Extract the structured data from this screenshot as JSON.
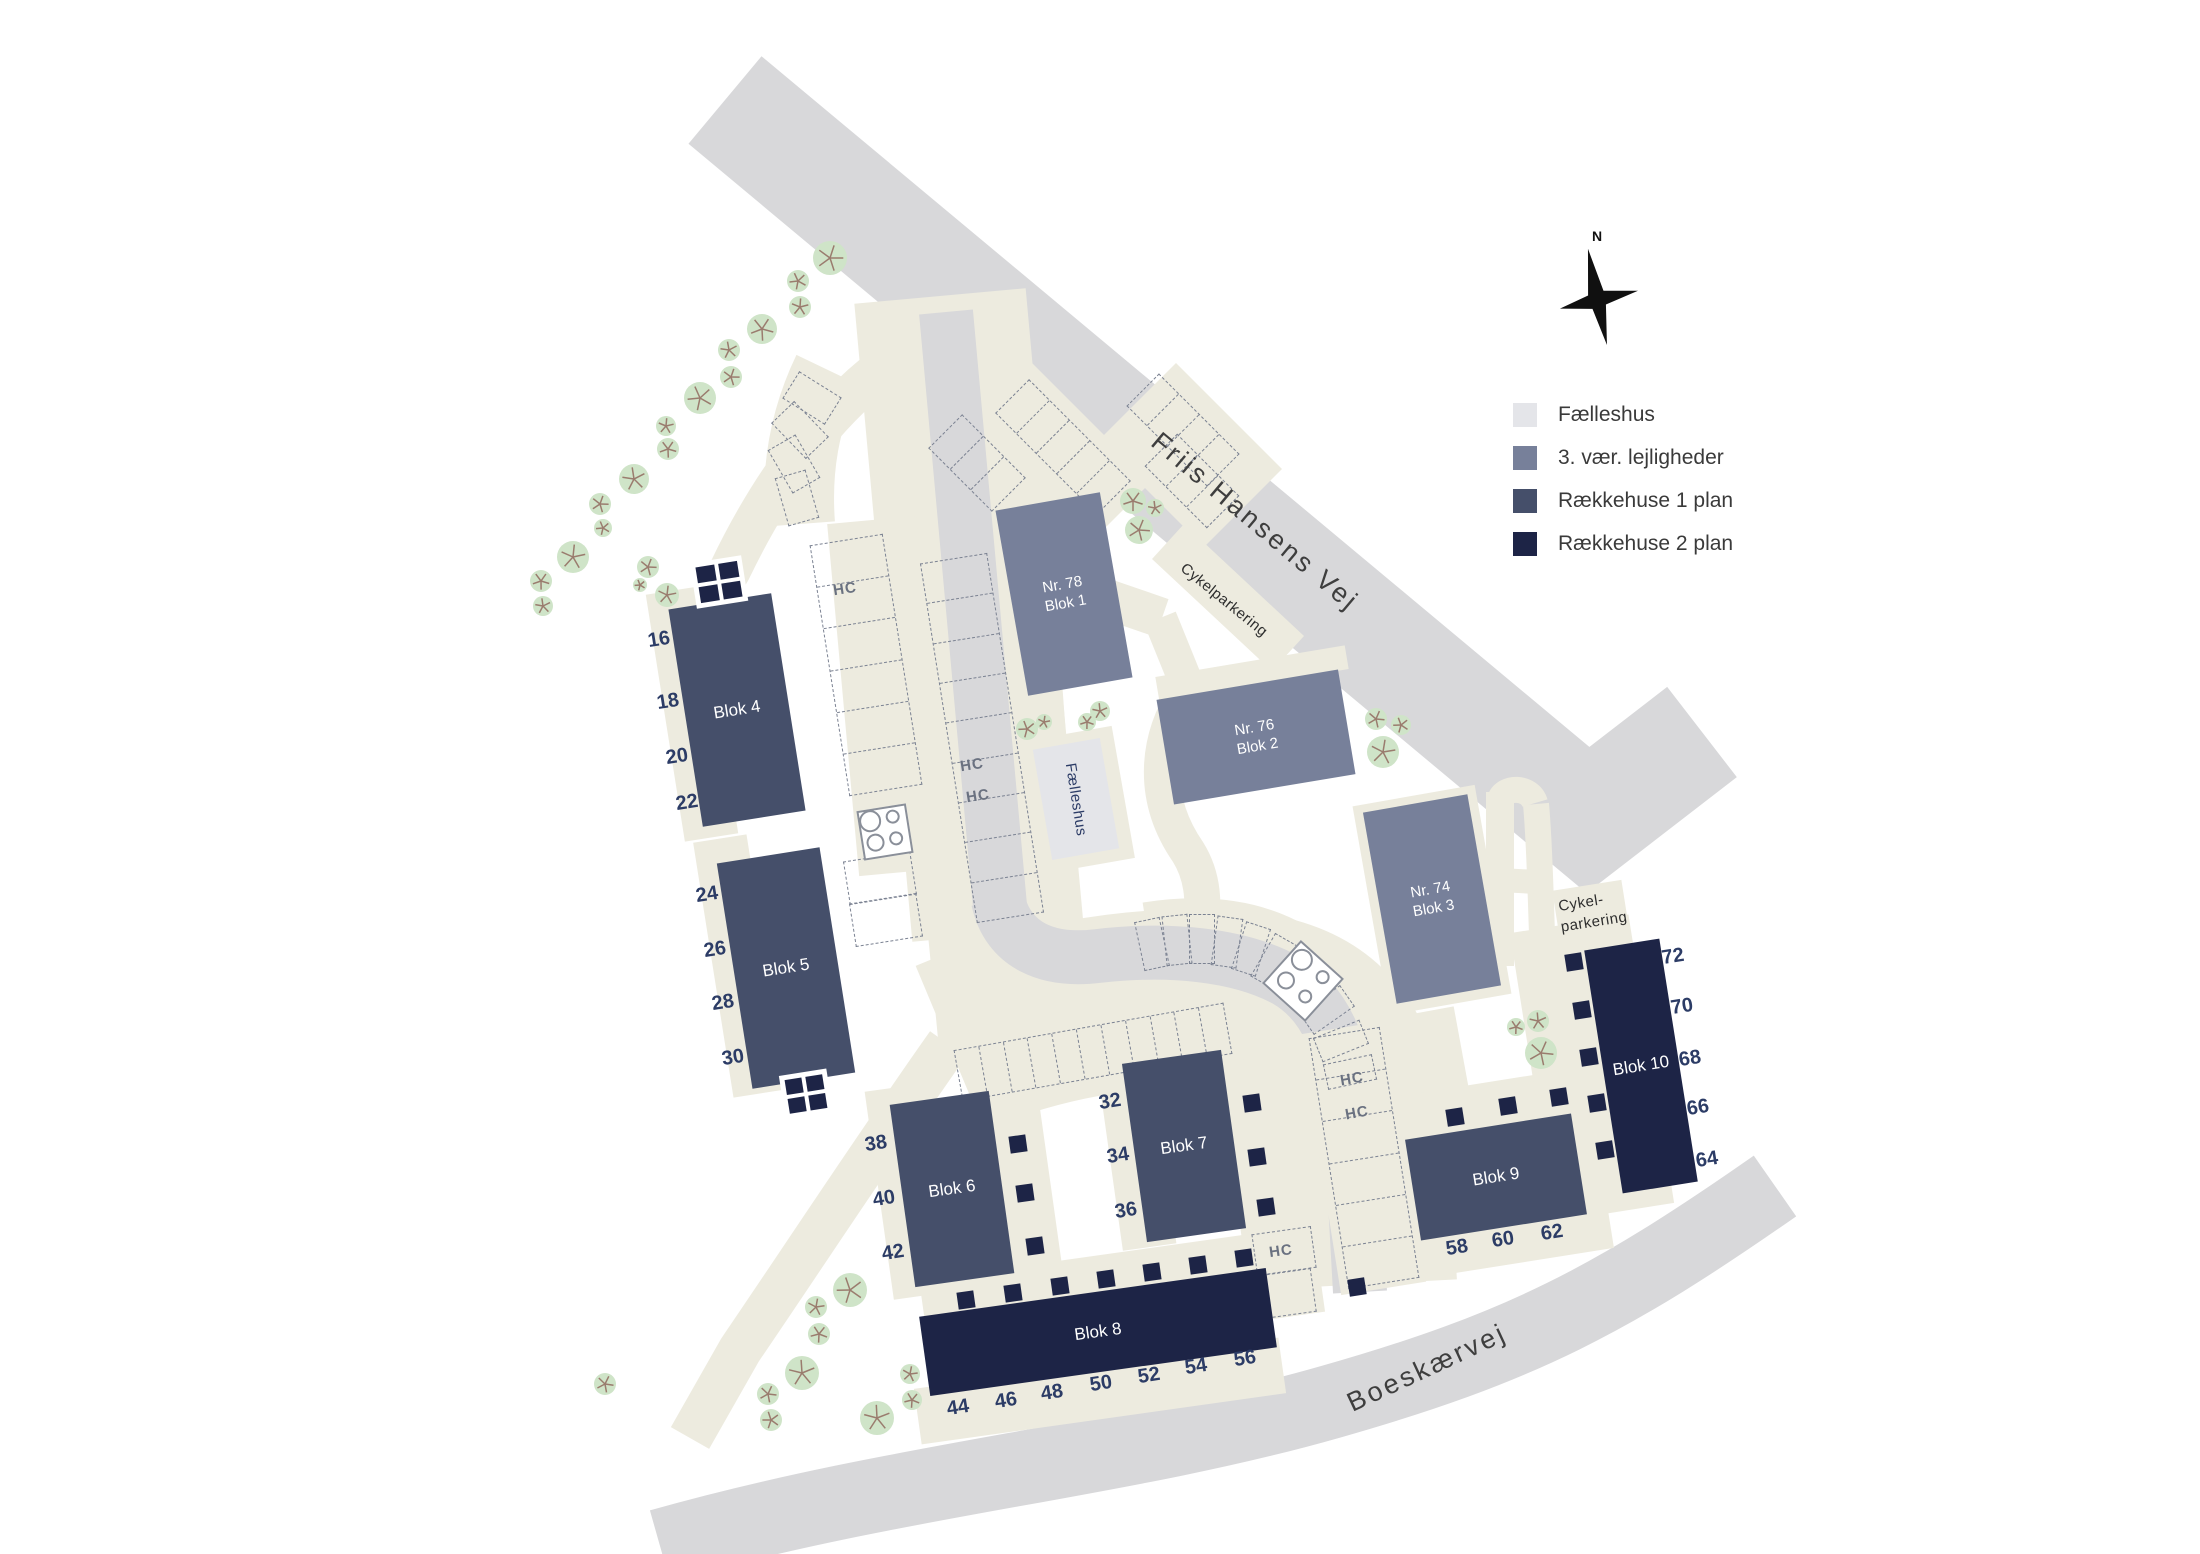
{
  "legend": {
    "items": [
      {
        "label": "Fælleshus",
        "color": "#e4e5e9"
      },
      {
        "label": "3. vær. lejligheder",
        "color": "#77809a"
      },
      {
        "label": "Rækkehuse 1 plan",
        "color": "#454f6a"
      },
      {
        "label": "Rækkehuse 2 plan",
        "color": "#1d2446"
      }
    ]
  },
  "compass": {
    "north_label": "N"
  },
  "streets": {
    "main_road": "Friis Hansens Vej",
    "south_road": "Boeskærvej"
  },
  "labels": {
    "bike_parking_inline": "Cykelparkering",
    "bike_parking_line1": "Cykel-",
    "bike_parking_line2": "parkering",
    "handicap": "HC",
    "common_house": "Fælleshus"
  },
  "blocks": {
    "blok1": {
      "line1": "Nr. 78",
      "line2": "Blok 1",
      "numbers": []
    },
    "blok2": {
      "line1": "Nr. 76",
      "line2": "Blok 2",
      "numbers": []
    },
    "blok3": {
      "line1": "Nr. 74",
      "line2": "Blok 3",
      "numbers": []
    },
    "blok4": {
      "line1": "",
      "line2": "Blok 4",
      "numbers": [
        "16",
        "18",
        "20",
        "22"
      ]
    },
    "blok5": {
      "line1": "",
      "line2": "Blok 5",
      "numbers": [
        "24",
        "26",
        "28",
        "30"
      ]
    },
    "blok6": {
      "line1": "",
      "line2": "Blok 6",
      "numbers": [
        "38",
        "40",
        "42"
      ]
    },
    "blok7": {
      "line1": "",
      "line2": "Blok 7",
      "numbers": [
        "32",
        "34",
        "36"
      ]
    },
    "blok8": {
      "line1": "",
      "line2": "Blok 8",
      "numbers": [
        "44",
        "46",
        "48",
        "50",
        "52",
        "54",
        "56"
      ]
    },
    "blok9": {
      "line1": "",
      "line2": "Blok 9",
      "numbers": [
        "58",
        "60",
        "62"
      ]
    },
    "blok10": {
      "line1": "",
      "line2": "Blok 10",
      "numbers": [
        "72",
        "70",
        "68",
        "66",
        "64"
      ]
    }
  },
  "colors": {
    "road": "#d8d8da",
    "path": "#edebdf",
    "apartments": "#77809a",
    "rowhouse1": "#454f6a",
    "rowhouse2": "#1d2446",
    "common": "#e4e5e9",
    "tree": "#cfe4c8",
    "tree_branch": "#9a7c6e",
    "dash": "#7b8292",
    "number_text": "#2c3c66"
  }
}
